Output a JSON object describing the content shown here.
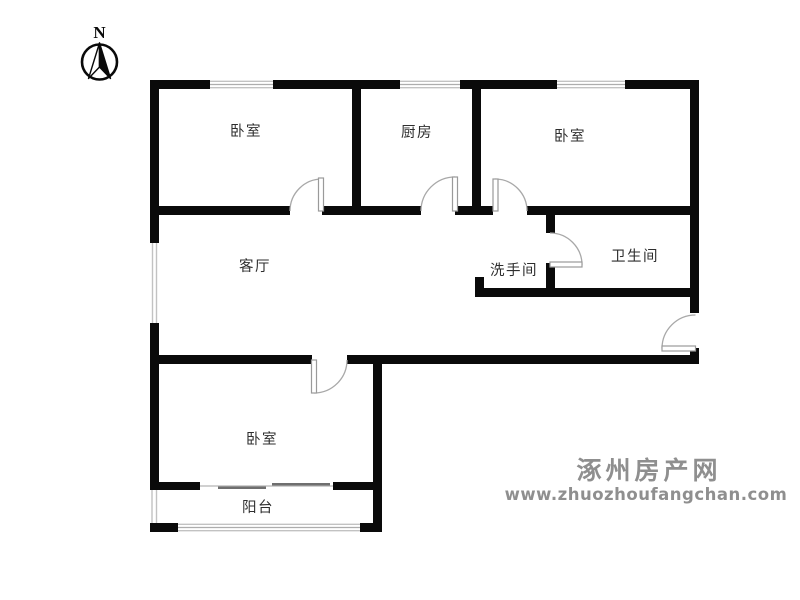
{
  "compass": {
    "label": "N"
  },
  "rooms": [
    {
      "id": "bedroom-top-left",
      "label": "卧室"
    },
    {
      "id": "kitchen",
      "label": "厨房"
    },
    {
      "id": "bedroom-top-right",
      "label": "卧室"
    },
    {
      "id": "living-room",
      "label": "客厅"
    },
    {
      "id": "washroom",
      "label": "洗手间"
    },
    {
      "id": "bathroom",
      "label": "卫生间"
    },
    {
      "id": "bedroom-bottom",
      "label": "卧室"
    },
    {
      "id": "balcony",
      "label": "阳台"
    }
  ],
  "watermark": {
    "site_name": "涿州房产网",
    "site_url": "www.zhuozhoufangchan.com",
    "color": "#8f8f8f"
  },
  "colors": {
    "wall": "#0a0a0a",
    "door": "#a8a8a8",
    "window_line": "#c2c2c2",
    "label_text": "#2e2e2e",
    "background": "#ffffff"
  }
}
